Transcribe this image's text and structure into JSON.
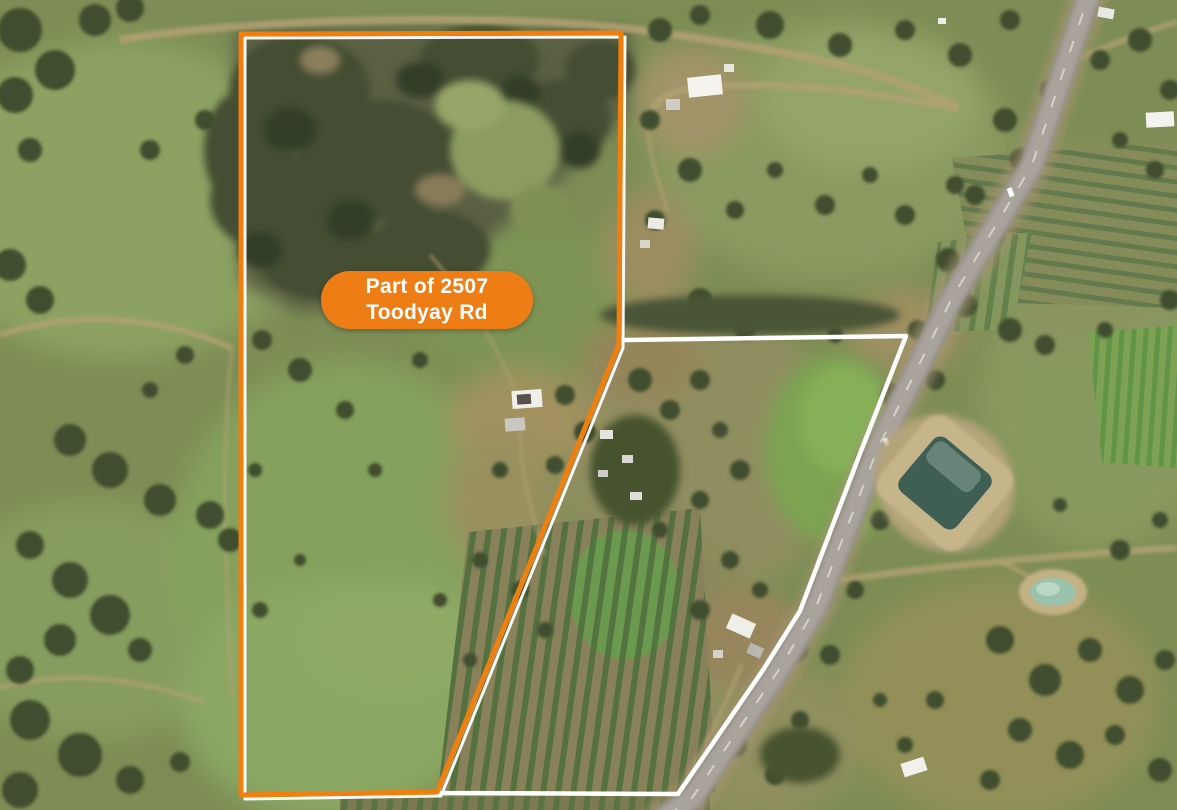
{
  "map": {
    "type": "aerial-satellite-photo",
    "label": {
      "line1": "Part of 2507",
      "line2": "Toodyay Rd"
    }
  },
  "colors": {
    "boundary_orange": "#EF7F0E",
    "boundary_white": "#FFFFFF",
    "label_background": "#EE7D15",
    "label_text": "#FFFFFF"
  }
}
